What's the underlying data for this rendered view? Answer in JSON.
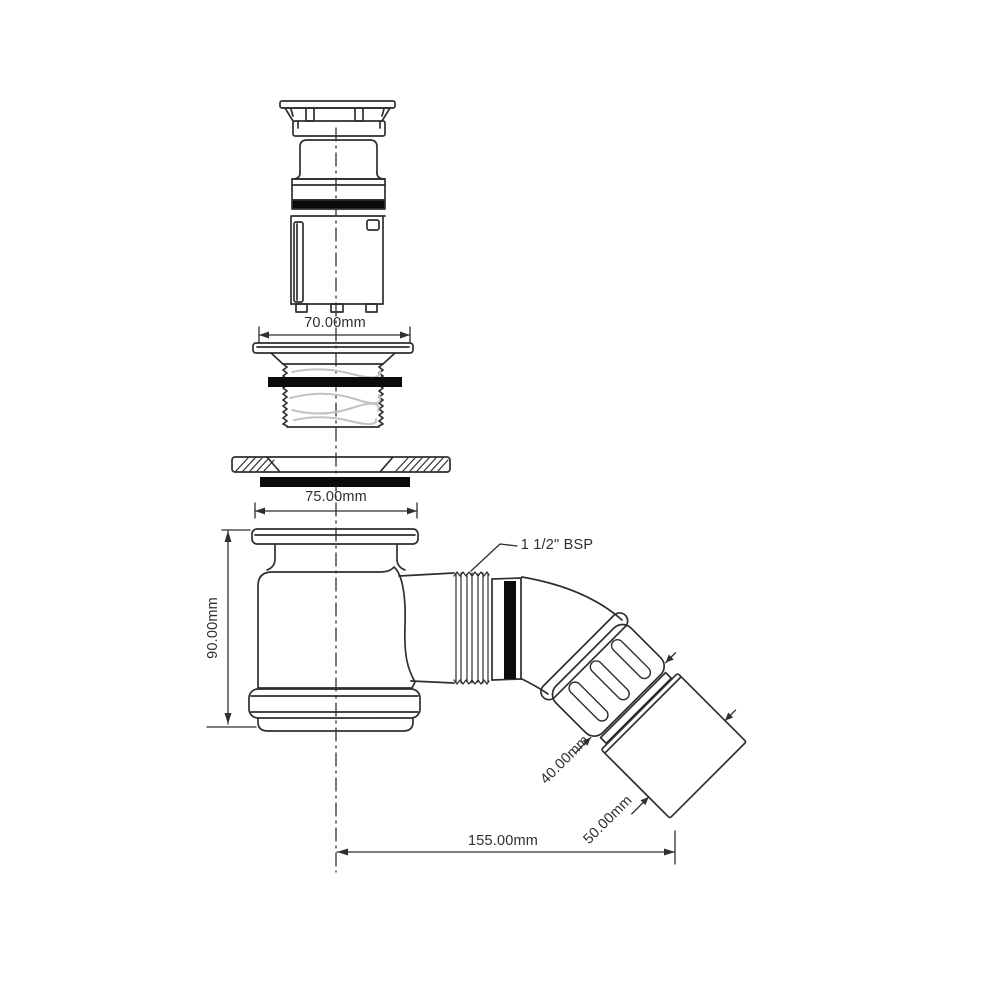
{
  "diagram": {
    "kind": "plumbing shower trap dimension drawing",
    "labels": {
      "dim_70": "70.00mm",
      "dim_75": "75.00mm",
      "dim_90": "90.00mm",
      "dim_40": "40.00mm",
      "dim_50": "50.00mm",
      "dim_155": "155.00mm",
      "thread_spec": "1 1/2\" BSP"
    },
    "colors": {
      "background": "#ffffff",
      "line": "#2f2f2f",
      "seal_black": "#0b0b0b",
      "thread_texture": "#c2c2c2"
    }
  }
}
